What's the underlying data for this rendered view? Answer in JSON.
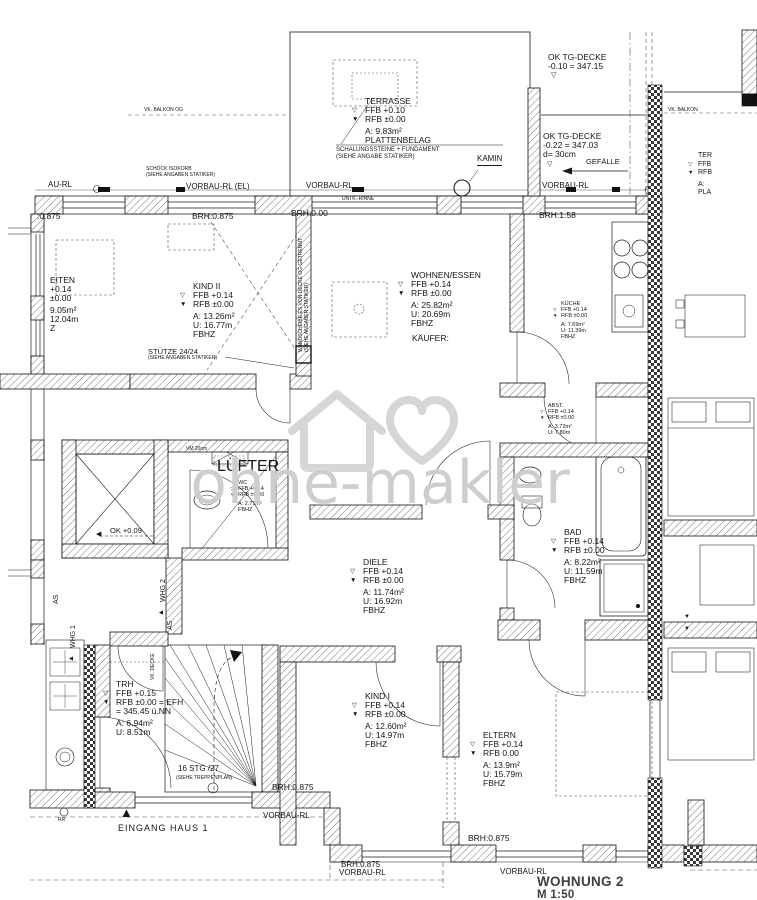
{
  "watermark": {
    "text": "ohne-makler"
  },
  "title_block": {
    "title": "WOHNUNG 2",
    "scale": "M 1:50"
  },
  "icons": {
    "ffb_marker": "▽",
    "rfb_marker": "▼",
    "entrance_triangle": "▲",
    "whg_marker": "▲",
    "arrow_left": "◀"
  },
  "annotations": {
    "au_rl": "AU-RL",
    "vorbau_rl_el": "VORBAU-RL (EL)",
    "vorbau_rl_mid": "VORBAU-RL",
    "untk_rinne": "UNTK.-RINNE",
    "vorbau_rl_right": "VORBAU-RL",
    "brh_0875_left": ":0.875",
    "brh_0875_top": "BRH:0.875",
    "brh_000": "BRH:0.00",
    "brh_158": "BRH:1.58",
    "schoeck1": "SCHÖCK ISOKORB",
    "schoeck2": "(SIEHE ANGABEN STATIKER)",
    "vk_balkon_left": "VK. BALKON OG",
    "vk_balkon_right": "VK. BALKON",
    "schalung1": "SCHALUNGSSTEINE + FUNDAMENT",
    "schalung2": "(SIEHE ANGABE STATIKER)",
    "kamin": "KAMIN",
    "tg1a": "OK TG-DECKE",
    "tg1b": "-0.10 = 347.15",
    "tg2a": "OK TG-DECKE",
    "tg2b": "-0.22 = 347.03",
    "tg2c": "d= 30cm",
    "gefaelle": "GEFÄLLE",
    "stuetze1": "STÜTZE 24/24",
    "stuetze2": "(SIEHE ANGABEN STATIKER)",
    "wand1": "WANDSCHEIBE ES VON DECKE OG GETRENNT",
    "wand2": "(SIEHE ANGABEN STATIKER)",
    "kaeufer": "KÄUFER:",
    "vm20": "VM 20cm",
    "luefter": "LÜFTER",
    "ok009": "OK +0.09",
    "whg1": "WHG 1",
    "whg2": "WHG 2",
    "as_left": "AS",
    "as_right": "AS",
    "vk_decke": "VK. DECKE",
    "stg1": "16 STG /27",
    "stg2": "(SIEHE TREPPENPLAN)",
    "brh_0875_stair": "BRH:0.875",
    "vorbau_rl_stair": "VORBAU-RL",
    "eingang": "EINGANG HAUS 1",
    "rr": "RR",
    "brh_0875_bottom_mid": "BRH:0.875",
    "brh_0875_bottom_left": "BRH:0.875",
    "vorbau_rl_bottom_left": "VORBAU-RL",
    "vorbau_rl_bottom_right": "VORBAU-RL"
  },
  "rooms": {
    "terrasse": {
      "name": "TERRASSE",
      "l1": "FFB +0.10",
      "l2": "RFB ±0.00",
      "l3": "A: 9.83m²",
      "l4": "PLATTENBELAG"
    },
    "arbeiten": {
      "name": "EITEN",
      "l1": "+0.14",
      "l2": "±0.00",
      "l3": "9.05m²",
      "l4": "12.04m",
      "l5": "Z"
    },
    "kind2": {
      "name": "KIND II",
      "l1": "FFB +0.14",
      "l2": "RFB ±0.00",
      "l3": "A: 13.26m²",
      "l4": "U: 16.77m",
      "l5": "FBHZ"
    },
    "wohnen": {
      "name": "WOHNEN/ESSEN",
      "l1": "FFB +0.14",
      "l2": "RFB ±0.00",
      "l3": "A: 25.82m²",
      "l4": "U: 20.69m",
      "l5": "FBHZ"
    },
    "kueche": {
      "name": "KÜCHE",
      "l1": "FFB +0.14",
      "l2": "RFB ±0.00",
      "l3": "A: 7.69m²",
      "l4": "U: 11.39m",
      "l5": "FBHZ"
    },
    "abst": {
      "name": "ABST.",
      "l1": "FFB +0.14",
      "l2": "RFB ±0.00",
      "l3": "A: 3.72m²",
      "l4": "U: 7.80m"
    },
    "wc": {
      "name": "WC",
      "l1": "FFB +0.14",
      "l2": "RFB ±0.00",
      "l3": "A: 2.71m²",
      "l4": "FBHZ"
    },
    "bad": {
      "name": "BAD",
      "l1": "FFB +0.14",
      "l2": "RFB ±0.00",
      "l3": "A: 8.22m²",
      "l4": "U: 11.59m",
      "l5": "FBHZ"
    },
    "diele": {
      "name": "DIELE",
      "l1": "FFB +0.14",
      "l2": "RFB ±0.00",
      "l3": "A: 11.74m²",
      "l4": "U: 16.92m",
      "l5": "FBHZ"
    },
    "kind1": {
      "name": "KIND I",
      "l1": "FFB +0.14",
      "l2": "RFB ±0.00",
      "l3": "A: 12.60m²",
      "l4": "U: 14.97m",
      "l5": "FBHZ"
    },
    "eltern": {
      "name": "ELTERN",
      "l1": "FFB +0.14",
      "l2": "RFB  0.00",
      "l3": "A: 13.9m²",
      "l4": "U: 15.79m",
      "l5": "FBHZ"
    },
    "trh": {
      "name": "TRH",
      "l1": "FFB +0.15",
      "l2": "RFB ±0.00 = EFH",
      "l3": "= 345.45 ü.NN",
      "l4": "A: 6.94m²",
      "l5": "U: 8.51m"
    },
    "ter_right": {
      "name": "TER",
      "l1": "FFB",
      "l2": "RFB",
      "l3": "A:",
      "l4": "PLA"
    }
  }
}
